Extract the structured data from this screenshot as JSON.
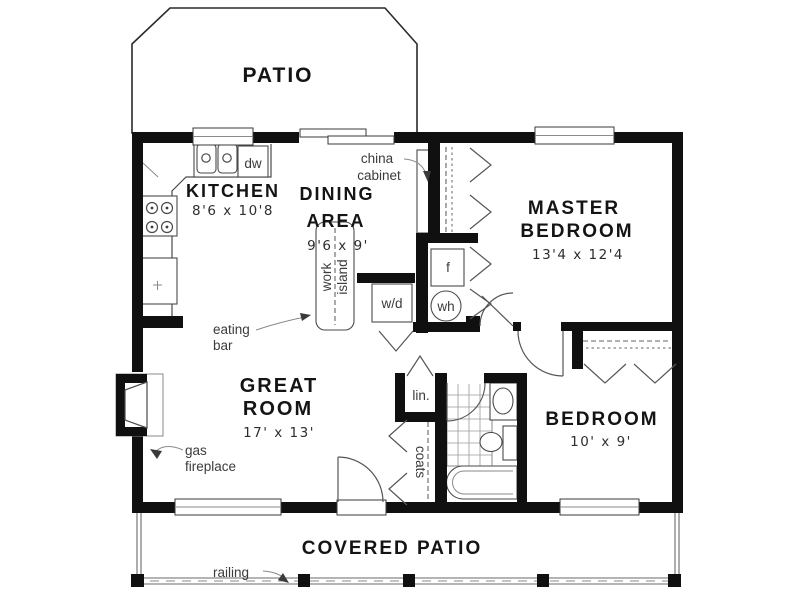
{
  "title": "Residential floor plan",
  "rooms": {
    "patio": {
      "label": "PATIO"
    },
    "kitchen": {
      "label": "KITCHEN",
      "dims": "8'6 x 10'8"
    },
    "dining_area": {
      "label_line1": "DINING",
      "label_line2": "AREA",
      "dims": "9'6 x 9'"
    },
    "master_bedroom": {
      "label_line1": "MASTER",
      "label_line2": "BEDROOM",
      "dims": "13'4 x 12'4"
    },
    "great_room": {
      "label_line1": "GREAT",
      "label_line2": "ROOM",
      "dims": "17' x 13'"
    },
    "bedroom": {
      "label": "BEDROOM",
      "dims": "10' x 9'"
    },
    "covered_patio": {
      "label": "COVERED PATIO"
    }
  },
  "annotations": {
    "china_cabinet": {
      "line1": "china",
      "line2": "cabinet"
    },
    "work_island": {
      "line1": "work",
      "line2": "island"
    },
    "eating_bar": {
      "line1": "eating",
      "line2": "bar"
    },
    "gas_fireplace": {
      "line1": "gas",
      "line2": "fireplace"
    },
    "coats_closet": "coats",
    "linen_closet": "lin.",
    "railing": "railing",
    "dishwasher": "dw",
    "washer_dryer": "w/d",
    "furnace": "f",
    "water_heater": "wh"
  },
  "colors": {
    "wall": "#101010",
    "line": "#4a4a4a",
    "thin_line": "#8a8a8a",
    "background": "#ffffff",
    "text": "#141414"
  }
}
